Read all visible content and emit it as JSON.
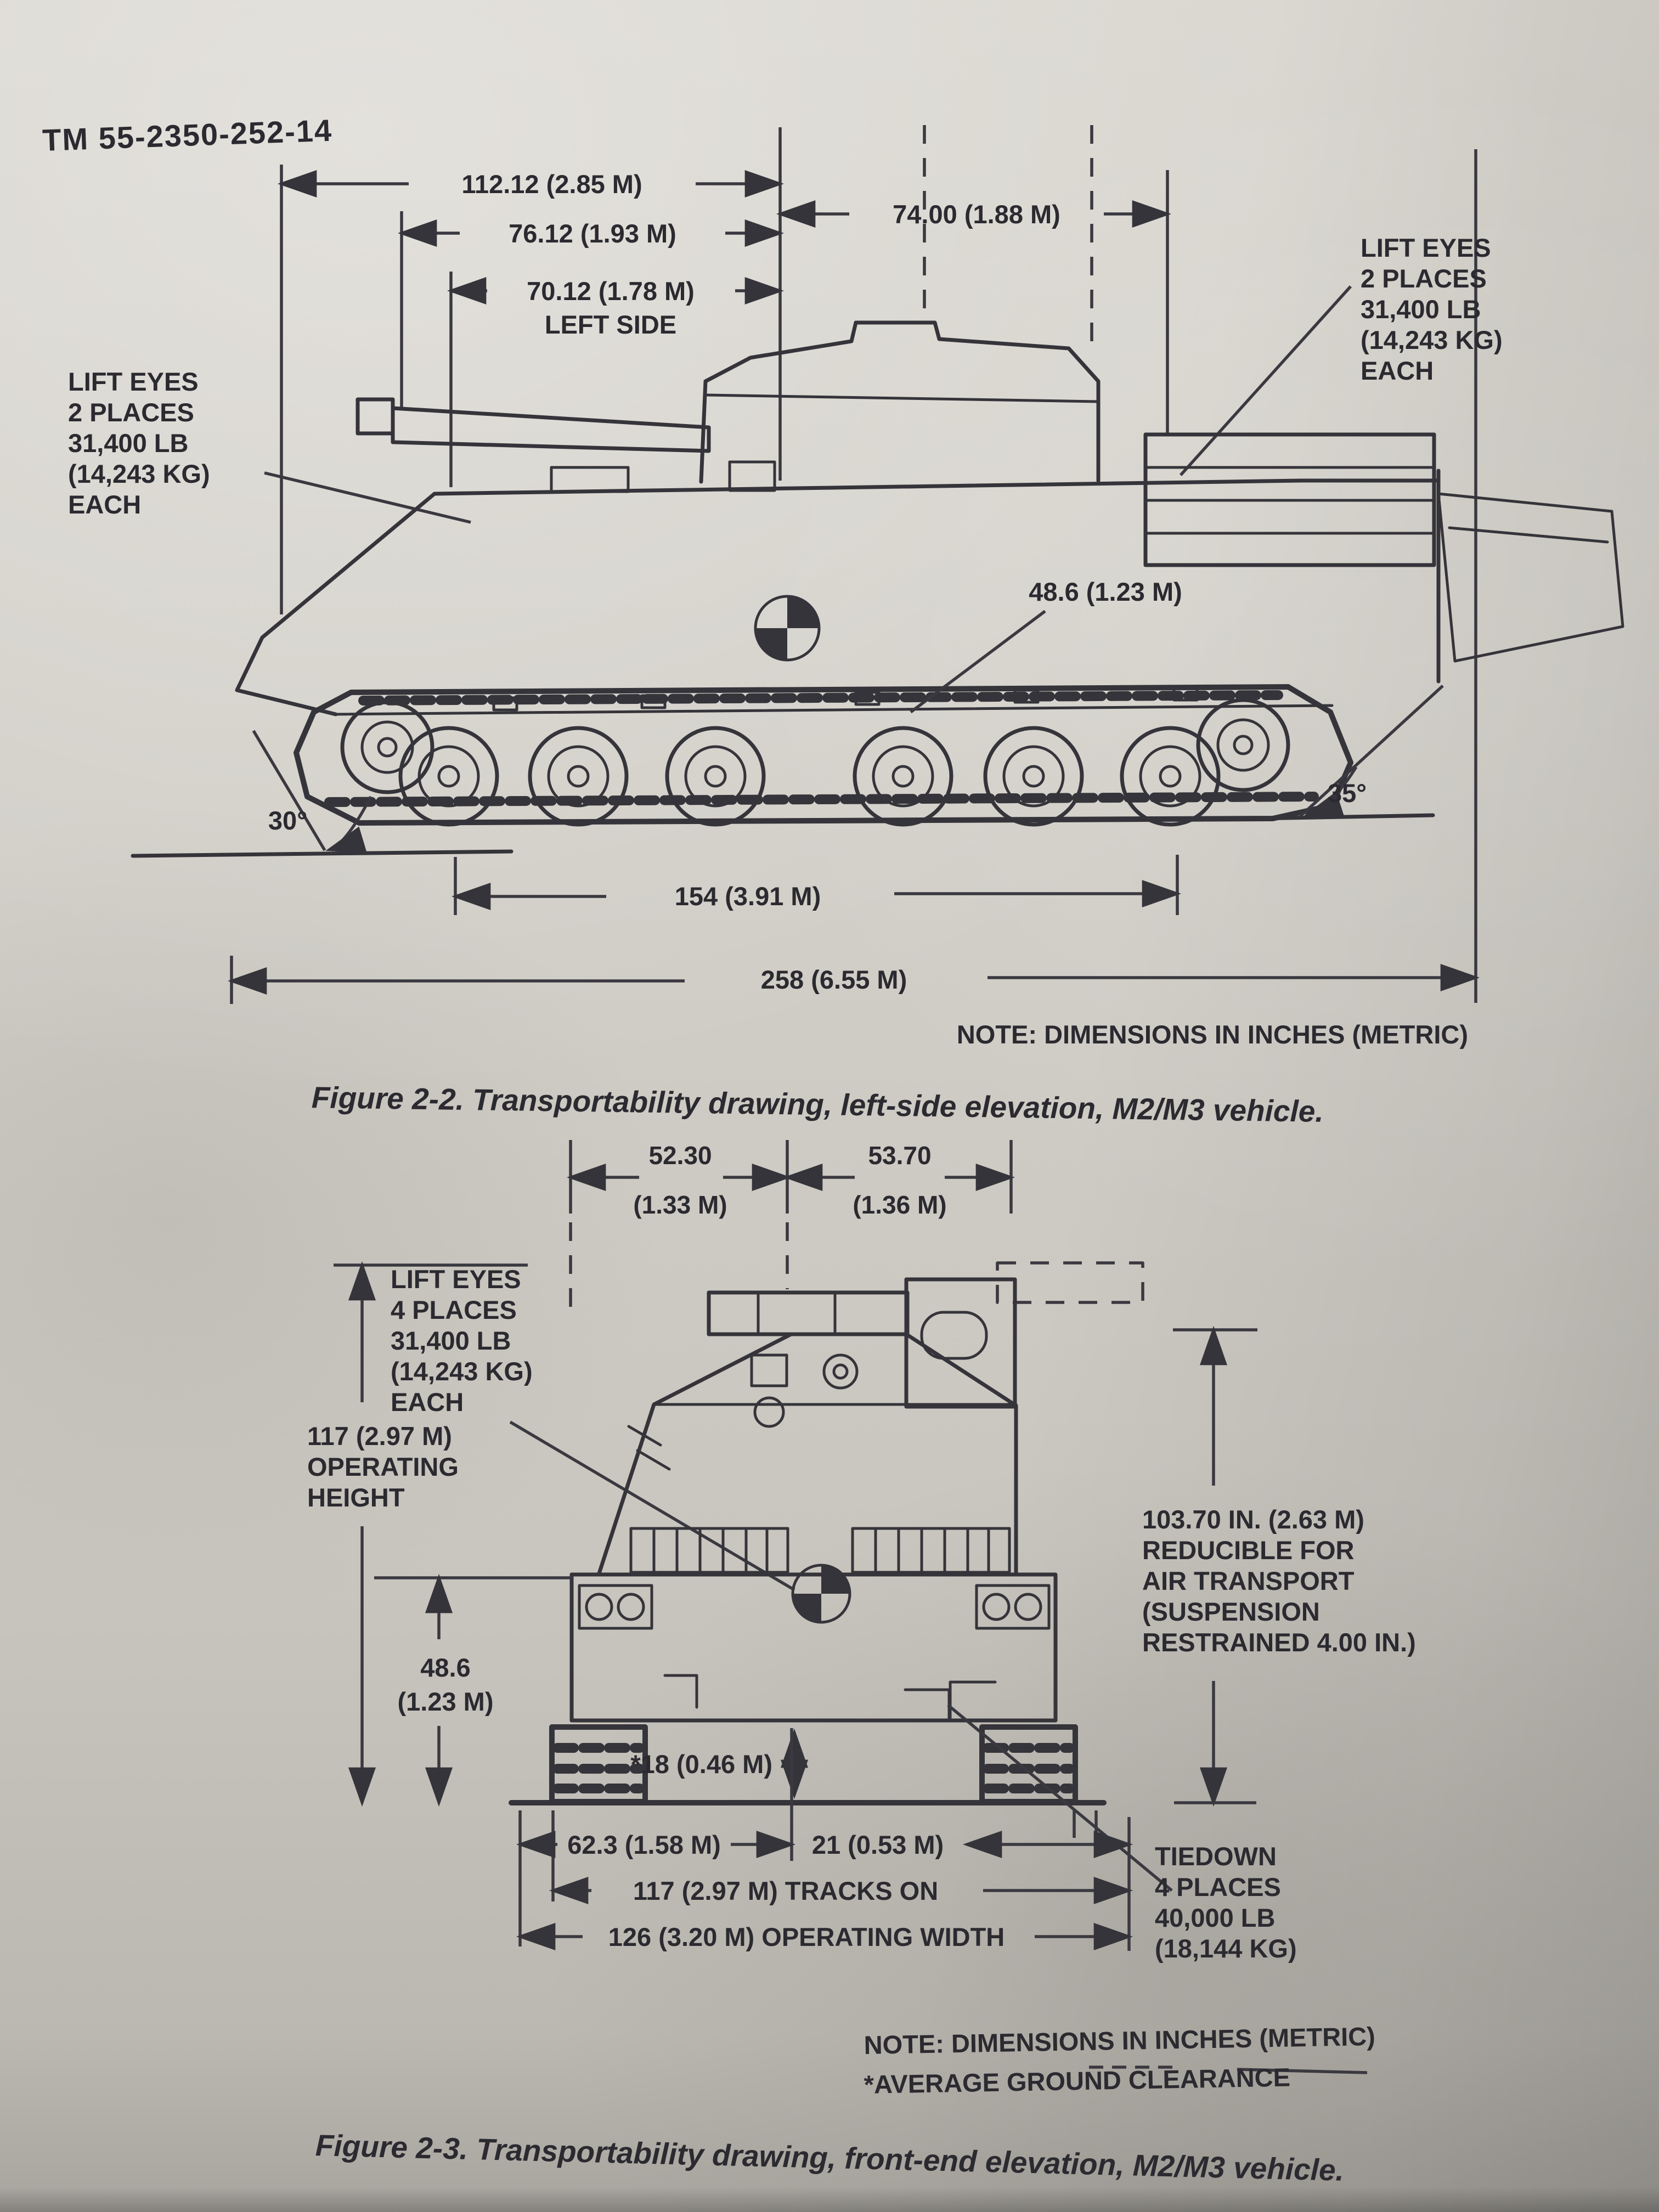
{
  "page": {
    "header": "TM 55-2350-252-14",
    "page_number": "2-6"
  },
  "fig22": {
    "dim_112": "112.12 (2.85 M)",
    "dim_76": "76.12 (1.93 M)",
    "dim_74": "74.00 (1.88 M)",
    "dim_70": "70.12 (1.78 M)",
    "left_side": "LEFT SIDE",
    "dim_486": "48.6 (1.23 M)",
    "dim_154": "154 (3.91 M)",
    "dim_258": "258 (6.55 M)",
    "angle_front": "30°",
    "angle_rear": "35°",
    "lift_left": [
      "LIFT EYES",
      "2 PLACES",
      "31,400 LB",
      "(14,243 KG)",
      "EACH"
    ],
    "lift_right": [
      "LIFT EYES",
      "2 PLACES",
      "31,400 LB",
      "(14,243 KG)",
      "EACH"
    ],
    "note": "NOTE: DIMENSIONS IN INCHES (METRIC)",
    "caption": "Figure 2-2. Transportability drawing, left-side elevation, M2/M3 vehicle."
  },
  "fig23": {
    "dim_5230": "52.30",
    "dim_5230_m": "(1.33 M)",
    "dim_5370": "53.70",
    "dim_5370_m": "(1.36 M)",
    "lift": [
      "LIFT EYES",
      "4 PLACES",
      "31,400 LB",
      "(14,243 KG)",
      "EACH"
    ],
    "height": [
      "117 (2.97 M)",
      "OPERATING",
      "HEIGHT"
    ],
    "dim_486": [
      "48.6",
      "(1.23 M)"
    ],
    "reducible": [
      "103.70 IN. (2.63 M)",
      "REDUCIBLE FOR",
      "AIR TRANSPORT",
      "(SUSPENSION",
      "RESTRAINED 4.00 IN.)"
    ],
    "clearance": "*18 (0.46 M)",
    "dim_623": "62.3 (1.58 M)",
    "dim_21": "21 (0.53 M)",
    "dim_tracks": "117 (2.97 M) TRACKS ON",
    "dim_width": "126 (3.20 M) OPERATING WIDTH",
    "tiedown": [
      "TIEDOWN",
      "4 PLACES",
      "40,000 LB",
      "(18,144 KG)"
    ],
    "note": "NOTE: DIMENSIONS IN INCHES (METRIC)",
    "note2": "*AVERAGE GROUND CLEARANCE",
    "caption": "Figure 2-3. Transportability drawing, front-end elevation, M2/M3 vehicle."
  }
}
